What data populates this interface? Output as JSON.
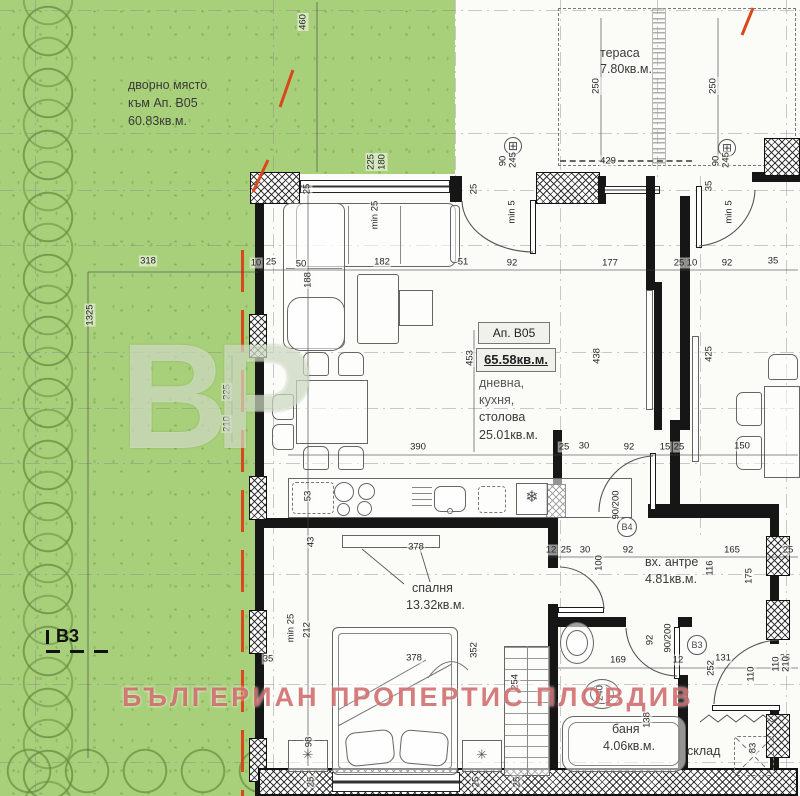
{
  "watermark": {
    "text": "БЪЛГЕРИАН ПРОПЕРТИС ПЛОВДИВ",
    "logo": "BP",
    "color": "#c95858"
  },
  "garden": {
    "line1": "дворно място",
    "line2": "към Ап. B05",
    "line3": "60.83кв.м.",
    "marker": "B3",
    "fill": "#a8d07a",
    "boundary_color": "#d9481c"
  },
  "info_box": {
    "apartment": "Ап. B05",
    "total_area": "65.58кв.м.",
    "rooms_line1": "дневна,",
    "rooms_line2": "кухня,",
    "rooms_line3": "столова",
    "area": "25.01кв.м."
  },
  "rooms": {
    "terrace": {
      "name": "тераса",
      "area": "7.80кв.м."
    },
    "bedroom": {
      "name": "спалня",
      "area": "13.32кв.м."
    },
    "hall": {
      "name": "вх. антре",
      "area": "4.81кв.м."
    },
    "bath": {
      "name": "баня",
      "area": "4.06кв.м."
    },
    "storage": {
      "name": "склад"
    }
  },
  "door_tags": {
    "b4": "B4",
    "b3": "B3",
    "b4_size": "90/200",
    "b3_size": "90/200",
    "window_size": "90/245",
    "entry_size": "110/210"
  },
  "icons": {
    "window_tag": "⊞",
    "fridge": "❄",
    "plant": "✳"
  },
  "dimensions": [
    {
      "t": "460",
      "x": 303,
      "y": 22,
      "r": 1
    },
    {
      "t": "250",
      "x": 596,
      "y": 86,
      "r": 1
    },
    {
      "t": "250",
      "x": 713,
      "y": 86,
      "r": 1
    },
    {
      "t": "429",
      "x": 608,
      "y": 161
    },
    {
      "t": "90",
      "x": 503,
      "y": 161,
      "r": 1
    },
    {
      "t": "245",
      "x": 513,
      "y": 160,
      "r": 1
    },
    {
      "t": "min 5",
      "x": 512,
      "y": 212,
      "r": 1
    },
    {
      "t": "90",
      "x": 716,
      "y": 161,
      "r": 1
    },
    {
      "t": "245",
      "x": 726,
      "y": 160,
      "r": 1
    },
    {
      "t": "min 5",
      "x": 729,
      "y": 212,
      "r": 1
    },
    {
      "t": "35",
      "x": 709,
      "y": 186,
      "r": 1
    },
    {
      "t": "25",
      "x": 307,
      "y": 189,
      "r": 1
    },
    {
      "t": "25",
      "x": 474,
      "y": 189,
      "r": 1
    },
    {
      "t": "225",
      "x": 371,
      "y": 162,
      "r": 1
    },
    {
      "t": "180",
      "x": 382,
      "y": 162,
      "r": 1
    },
    {
      "t": "min 25",
      "x": 375,
      "y": 215,
      "r": 1
    },
    {
      "t": "318",
      "x": 148,
      "y": 261
    },
    {
      "t": "1325",
      "x": 90,
      "y": 315,
      "r": 1
    },
    {
      "t": "10",
      "x": 256,
      "y": 263
    },
    {
      "t": "25",
      "x": 271,
      "y": 262
    },
    {
      "t": "50",
      "x": 301,
      "y": 264
    },
    {
      "t": "182",
      "x": 382,
      "y": 262
    },
    {
      "t": "51",
      "x": 463,
      "y": 262
    },
    {
      "t": "92",
      "x": 512,
      "y": 263
    },
    {
      "t": "177",
      "x": 610,
      "y": 263
    },
    {
      "t": "25",
      "x": 679,
      "y": 263
    },
    {
      "t": "10",
      "x": 692,
      "y": 263
    },
    {
      "t": "92",
      "x": 727,
      "y": 263
    },
    {
      "t": "35",
      "x": 773,
      "y": 261
    },
    {
      "t": "188",
      "x": 308,
      "y": 280,
      "r": 1
    },
    {
      "t": "225",
      "x": 227,
      "y": 392,
      "r": 1
    },
    {
      "t": "210",
      "x": 227,
      "y": 424,
      "r": 1
    },
    {
      "t": "453",
      "x": 470,
      "y": 358,
      "r": 1
    },
    {
      "t": "438",
      "x": 597,
      "y": 356,
      "r": 1
    },
    {
      "t": "425",
      "x": 709,
      "y": 354,
      "r": 1
    },
    {
      "t": "390",
      "x": 418,
      "y": 447
    },
    {
      "t": "25",
      "x": 564,
      "y": 447
    },
    {
      "t": "30",
      "x": 584,
      "y": 446
    },
    {
      "t": "92",
      "x": 629,
      "y": 447
    },
    {
      "t": "15",
      "x": 665,
      "y": 447
    },
    {
      "t": "25",
      "x": 679,
      "y": 447
    },
    {
      "t": "150",
      "x": 742,
      "y": 446
    },
    {
      "t": "53",
      "x": 308,
      "y": 496,
      "r": 1
    },
    {
      "t": "43",
      "x": 311,
      "y": 542,
      "r": 1
    },
    {
      "t": "378",
      "x": 416,
      "y": 547
    },
    {
      "t": "12",
      "x": 551,
      "y": 550
    },
    {
      "t": "25",
      "x": 566,
      "y": 550
    },
    {
      "t": "30",
      "x": 585,
      "y": 550
    },
    {
      "t": "92",
      "x": 628,
      "y": 550
    },
    {
      "t": "165",
      "x": 732,
      "y": 550
    },
    {
      "t": "25",
      "x": 788,
      "y": 550
    },
    {
      "t": "100",
      "x": 599,
      "y": 563,
      "r": 1
    },
    {
      "t": "116",
      "x": 710,
      "y": 568,
      "r": 1
    },
    {
      "t": "175",
      "x": 749,
      "y": 576,
      "r": 1
    },
    {
      "t": "90/200",
      "x": 616,
      "y": 505,
      "r": 1
    },
    {
      "t": "min 25",
      "x": 291,
      "y": 628,
      "r": 1
    },
    {
      "t": "212",
      "x": 307,
      "y": 630,
      "r": 1
    },
    {
      "t": "378",
      "x": 414,
      "y": 658
    },
    {
      "t": "352",
      "x": 474,
      "y": 650,
      "r": 1
    },
    {
      "t": "98",
      "x": 309,
      "y": 742,
      "r": 1
    },
    {
      "t": "254",
      "x": 515,
      "y": 682,
      "r": 1
    },
    {
      "t": "35",
      "x": 268,
      "y": 659
    },
    {
      "t": "169",
      "x": 618,
      "y": 660
    },
    {
      "t": "12",
      "x": 678,
      "y": 660
    },
    {
      "t": "131",
      "x": 723,
      "y": 658
    },
    {
      "t": "26",
      "x": 785,
      "y": 658
    },
    {
      "t": "92",
      "x": 650,
      "y": 640,
      "r": 1
    },
    {
      "t": "90/200",
      "x": 668,
      "y": 638,
      "r": 1
    },
    {
      "t": "252",
      "x": 711,
      "y": 668,
      "r": 1
    },
    {
      "t": "110",
      "x": 751,
      "y": 674,
      "r": 1
    },
    {
      "t": "110",
      "x": 776,
      "y": 664,
      "r": 1
    },
    {
      "t": "210",
      "x": 786,
      "y": 664,
      "r": 1
    },
    {
      "t": "240",
      "x": 600,
      "y": 693,
      "r": 1
    },
    {
      "t": "138",
      "x": 647,
      "y": 720,
      "r": 1
    },
    {
      "t": "83",
      "x": 753,
      "y": 748,
      "r": 1
    },
    {
      "t": "25",
      "x": 311,
      "y": 782,
      "r": 1
    },
    {
      "t": "25",
      "x": 476,
      "y": 782,
      "r": 1
    },
    {
      "t": "25",
      "x": 517,
      "y": 782,
      "r": 1
    }
  ]
}
